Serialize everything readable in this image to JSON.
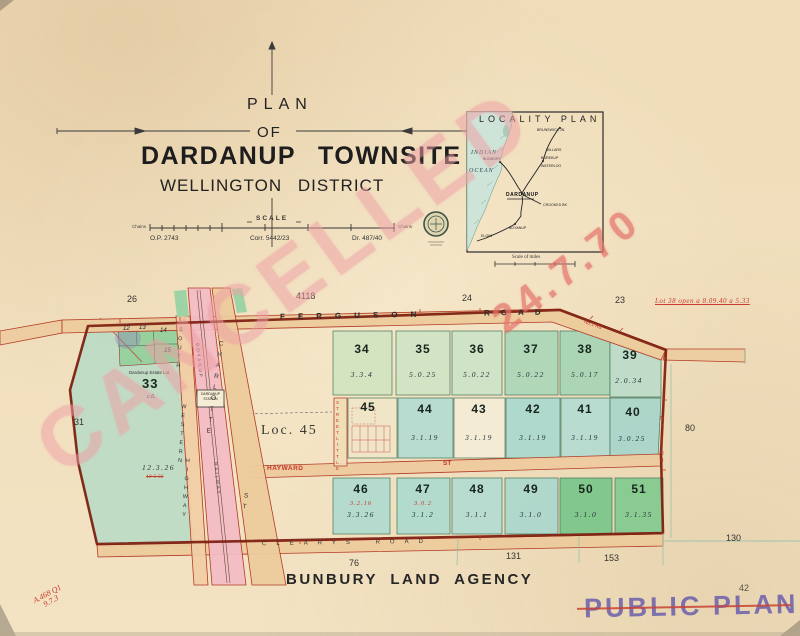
{
  "header": {
    "plan": "PLAN",
    "of": "OF",
    "townsite": "DARDANUP TOWNSITE",
    "district": "WELLINGTON DISTRICT",
    "scale_label": "SCALE",
    "chains_left": "Chains",
    "chains_right": "Chains",
    "refs": {
      "op": "O.P. 2743",
      "corr": "Corr. 5442/23",
      "dr": "Dr. 487/40"
    }
  },
  "locality": {
    "title": "LOCALITY PLAN",
    "indian": "INDIAN",
    "ocean": "OCEAN",
    "bunbury": "BUNBURY",
    "brunswick": "BRUNSWICK JN",
    "millars": "MILLARS",
    "burekup": "BUREKUP",
    "waterloo": "WATERLOO",
    "dardanup": "DARDANUP",
    "crooked": "CROOKED BK",
    "boyanup": "BOYANUP",
    "elgin": "ELGIN",
    "scale_miles": "Scale of miles"
  },
  "map": {
    "border_numbers": {
      "n26": "26",
      "n4118": "4118",
      "n24": "24",
      "n23": "23",
      "n31": "31",
      "n80": "80",
      "n130": "130",
      "n76": "76",
      "n131": "131",
      "n153": "153"
    },
    "red_note": "Lot 38 open   a 8.09.40   a 5.33",
    "roads": {
      "ferguson": "FERGUSON",
      "ferguson_road": "ROAD",
      "clearys": "CLEARYS ROAD",
      "hayward": "HAYWARD",
      "hayward_st": "ST",
      "little_street_1": "STREET",
      "little_street_2": "LITTLE",
      "charlotte": "CHARLOTTE",
      "charlotte_st": "ST",
      "south": "SOUTH",
      "western": "WESTERN",
      "highway": "HIGHWAY",
      "railway_1": "BOYANUP",
      "railway_2": "RAILWAY",
      "station_1": "DARDANUP",
      "station_2": "STATION",
      "no1_rd": "No.1 Rd"
    },
    "loc_label": "Loc. 45",
    "estate_label": "Dardanup Estate Lot",
    "lot33": {
      "n": "33",
      "sub": "c.6.",
      "area": "12.3.26",
      "struck": "10-5-56"
    },
    "small_lots": {
      "l12": "12",
      "l13": "13",
      "l14": "14",
      "l15": "15"
    },
    "lots": {
      "34": {
        "n": "34",
        "a": "3.3.4"
      },
      "35": {
        "n": "35",
        "a": "5.0.25"
      },
      "36": {
        "n": "36",
        "a": "5.0.22"
      },
      "37": {
        "n": "37",
        "a": "5.0.22"
      },
      "38": {
        "n": "38",
        "a": "5.0.17"
      },
      "39": {
        "n": "39",
        "a": "2.0.34"
      },
      "40": {
        "n": "40",
        "a": "3.0.25"
      },
      "41": {
        "n": "41",
        "a": "3.1.19"
      },
      "42": {
        "n": "42",
        "a": "3.1.19"
      },
      "43": {
        "n": "43",
        "a": "3.1.19"
      },
      "44": {
        "n": "44",
        "a": "3.1.19"
      },
      "45": {
        "n": "45",
        "a": ""
      },
      "46": {
        "n": "46",
        "a": "3.3.26",
        "red": "3.2.16"
      },
      "47": {
        "n": "47",
        "a": "3.1.2",
        "red": "3.0.2"
      },
      "48": {
        "n": "48",
        "a": "3.1.1"
      },
      "49": {
        "n": "49",
        "a": "3.1.0"
      },
      "50": {
        "n": "50",
        "a": "3.1.0"
      },
      "51": {
        "n": "51",
        "a": "3.1.35"
      }
    }
  },
  "footer": {
    "agency": "BUNBURY LAND AGENCY"
  },
  "stamps": {
    "cancelled": "CANCELLED",
    "date": "24.7.70",
    "public_plan": "PUBLIC PLAN.",
    "pencil": "42",
    "corner_note_1": "A.468 Q1",
    "corner_note_2": "9.7.3"
  },
  "colors": {
    "paper": "#f0debc",
    "road_tan": "#ecca9c",
    "railway_pink": "#f2bcc4",
    "boundary_red": "#7d1d0f",
    "lot_teal": "#b3dbd1",
    "lot_green": "#a9d6b0",
    "lot_bright_green": "#7cc68a",
    "stamp_pink": "#efa0a6",
    "stamp_purple": "#7468ac",
    "red_ink": "#c4392b"
  }
}
